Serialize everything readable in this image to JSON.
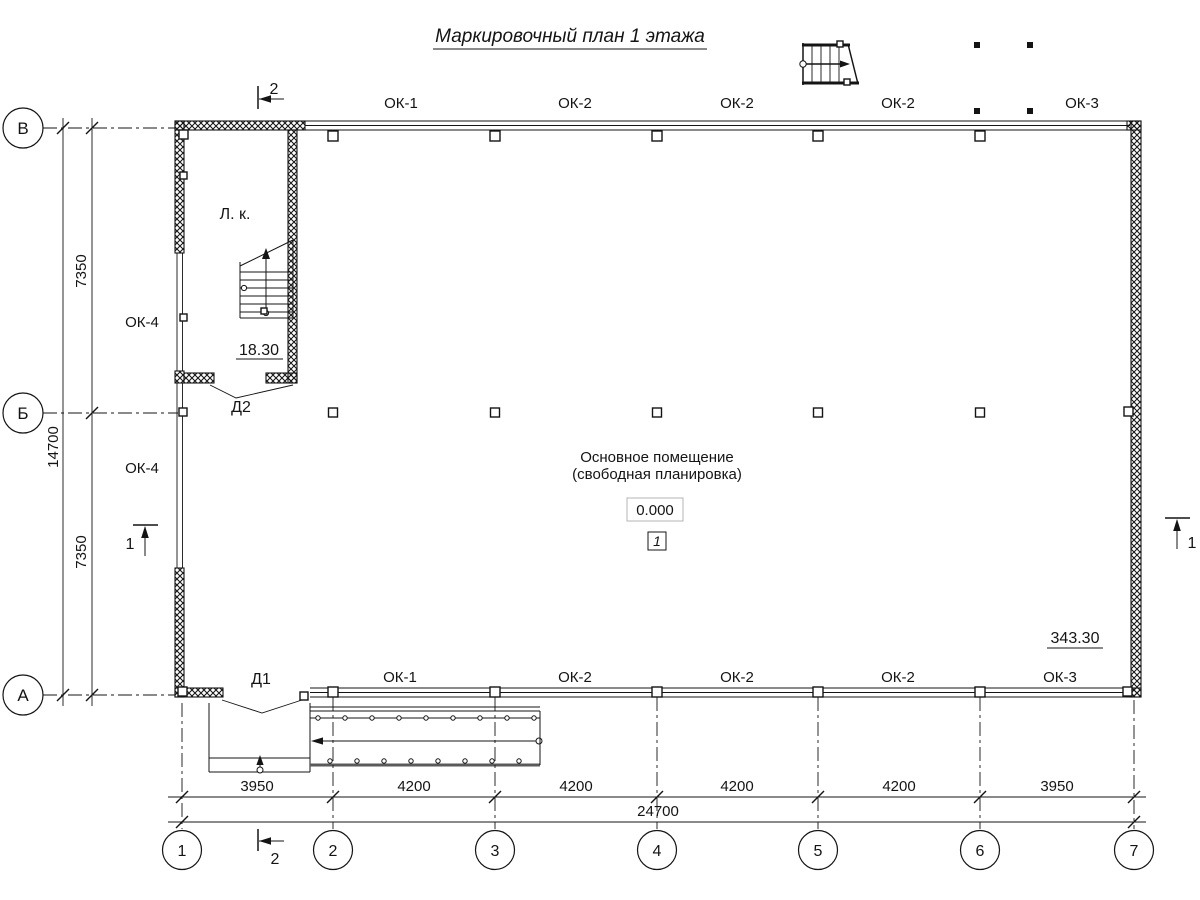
{
  "title": "Маркировочный план 1 этажа",
  "axes": {
    "rows": [
      "В",
      "Б",
      "А"
    ],
    "cols": [
      "1",
      "2",
      "3",
      "4",
      "5",
      "6",
      "7"
    ]
  },
  "windows": {
    "top": [
      "ОК-1",
      "ОК-2",
      "ОК-2",
      "ОК-2",
      "ОК-3"
    ],
    "bottom": [
      "ОК-1",
      "ОК-2",
      "ОК-2",
      "ОК-2",
      "ОК-3"
    ],
    "left": [
      "ОК-4",
      "ОК-4"
    ]
  },
  "doors": {
    "d1": "Д1",
    "d2": "Д2"
  },
  "stair": {
    "label": "Л. к.",
    "area": "18.30"
  },
  "room": {
    "line1": "Основное помещение",
    "line2": "(свободная планировка)",
    "elevation": "0.000",
    "number": "1",
    "area": "343.30"
  },
  "dimensions": {
    "bottom": [
      "3950",
      "4200",
      "4200",
      "4200",
      "4200",
      "3950"
    ],
    "bottom_total": "24700",
    "left": [
      "7350",
      "7350"
    ],
    "left_total": "14700"
  },
  "sections": {
    "one": "1",
    "two": "2"
  }
}
